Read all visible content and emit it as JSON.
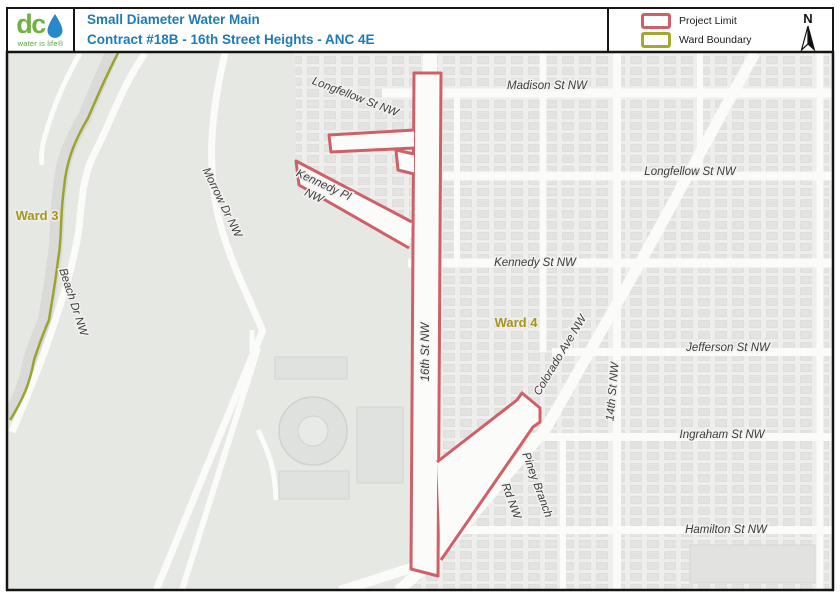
{
  "header": {
    "title_line1": "Small Diameter Water Main",
    "title_line2": "Contract #18B - 16th Street Heights - ANC 4E"
  },
  "logo": {
    "wordmark": "dc",
    "tagline": "water is life®"
  },
  "legend": {
    "items": [
      {
        "label": "Project Limit",
        "color": "#cf6068"
      },
      {
        "label": "Ward Boundary",
        "color": "#a4a82f"
      }
    ],
    "north_label": "N"
  },
  "map": {
    "ward_labels": {
      "ward3": "Ward 3",
      "ward4": "Ward 4"
    },
    "street_labels": {
      "madison": "Madison St NW",
      "longfellow_west": "Longfellow St NW",
      "longfellow_east": "Longfellow St NW",
      "kennedy_pl_line1": "Kennedy Pl",
      "kennedy_pl_line2": "NW",
      "kennedy": "Kennedy St NW",
      "sixteenth": "16th St NW",
      "colorado": "Colorado Ave NW",
      "fourteenth": "14th St NW",
      "jefferson": "Jefferson St NW",
      "ingraham": "Ingraham St NW",
      "hamilton": "Hamilton St NW",
      "piney_line1": "Piney Branch",
      "piney_line2": "Rd NW",
      "morrow": "Morrow Dr NW",
      "beach": "Beach Dr NW"
    },
    "colors": {
      "project_limit": "#cf6068",
      "ward_boundary": "#9da32f",
      "ward_label": "#a8941f",
      "park": "#e6e8e3",
      "urban": "#eeeeec",
      "road": "#fbfbfa",
      "creek": "#d8d8d6",
      "title_blue": "#1f7ab8",
      "logo_green": "#72b043",
      "drop_blue": "#2789cb"
    }
  }
}
